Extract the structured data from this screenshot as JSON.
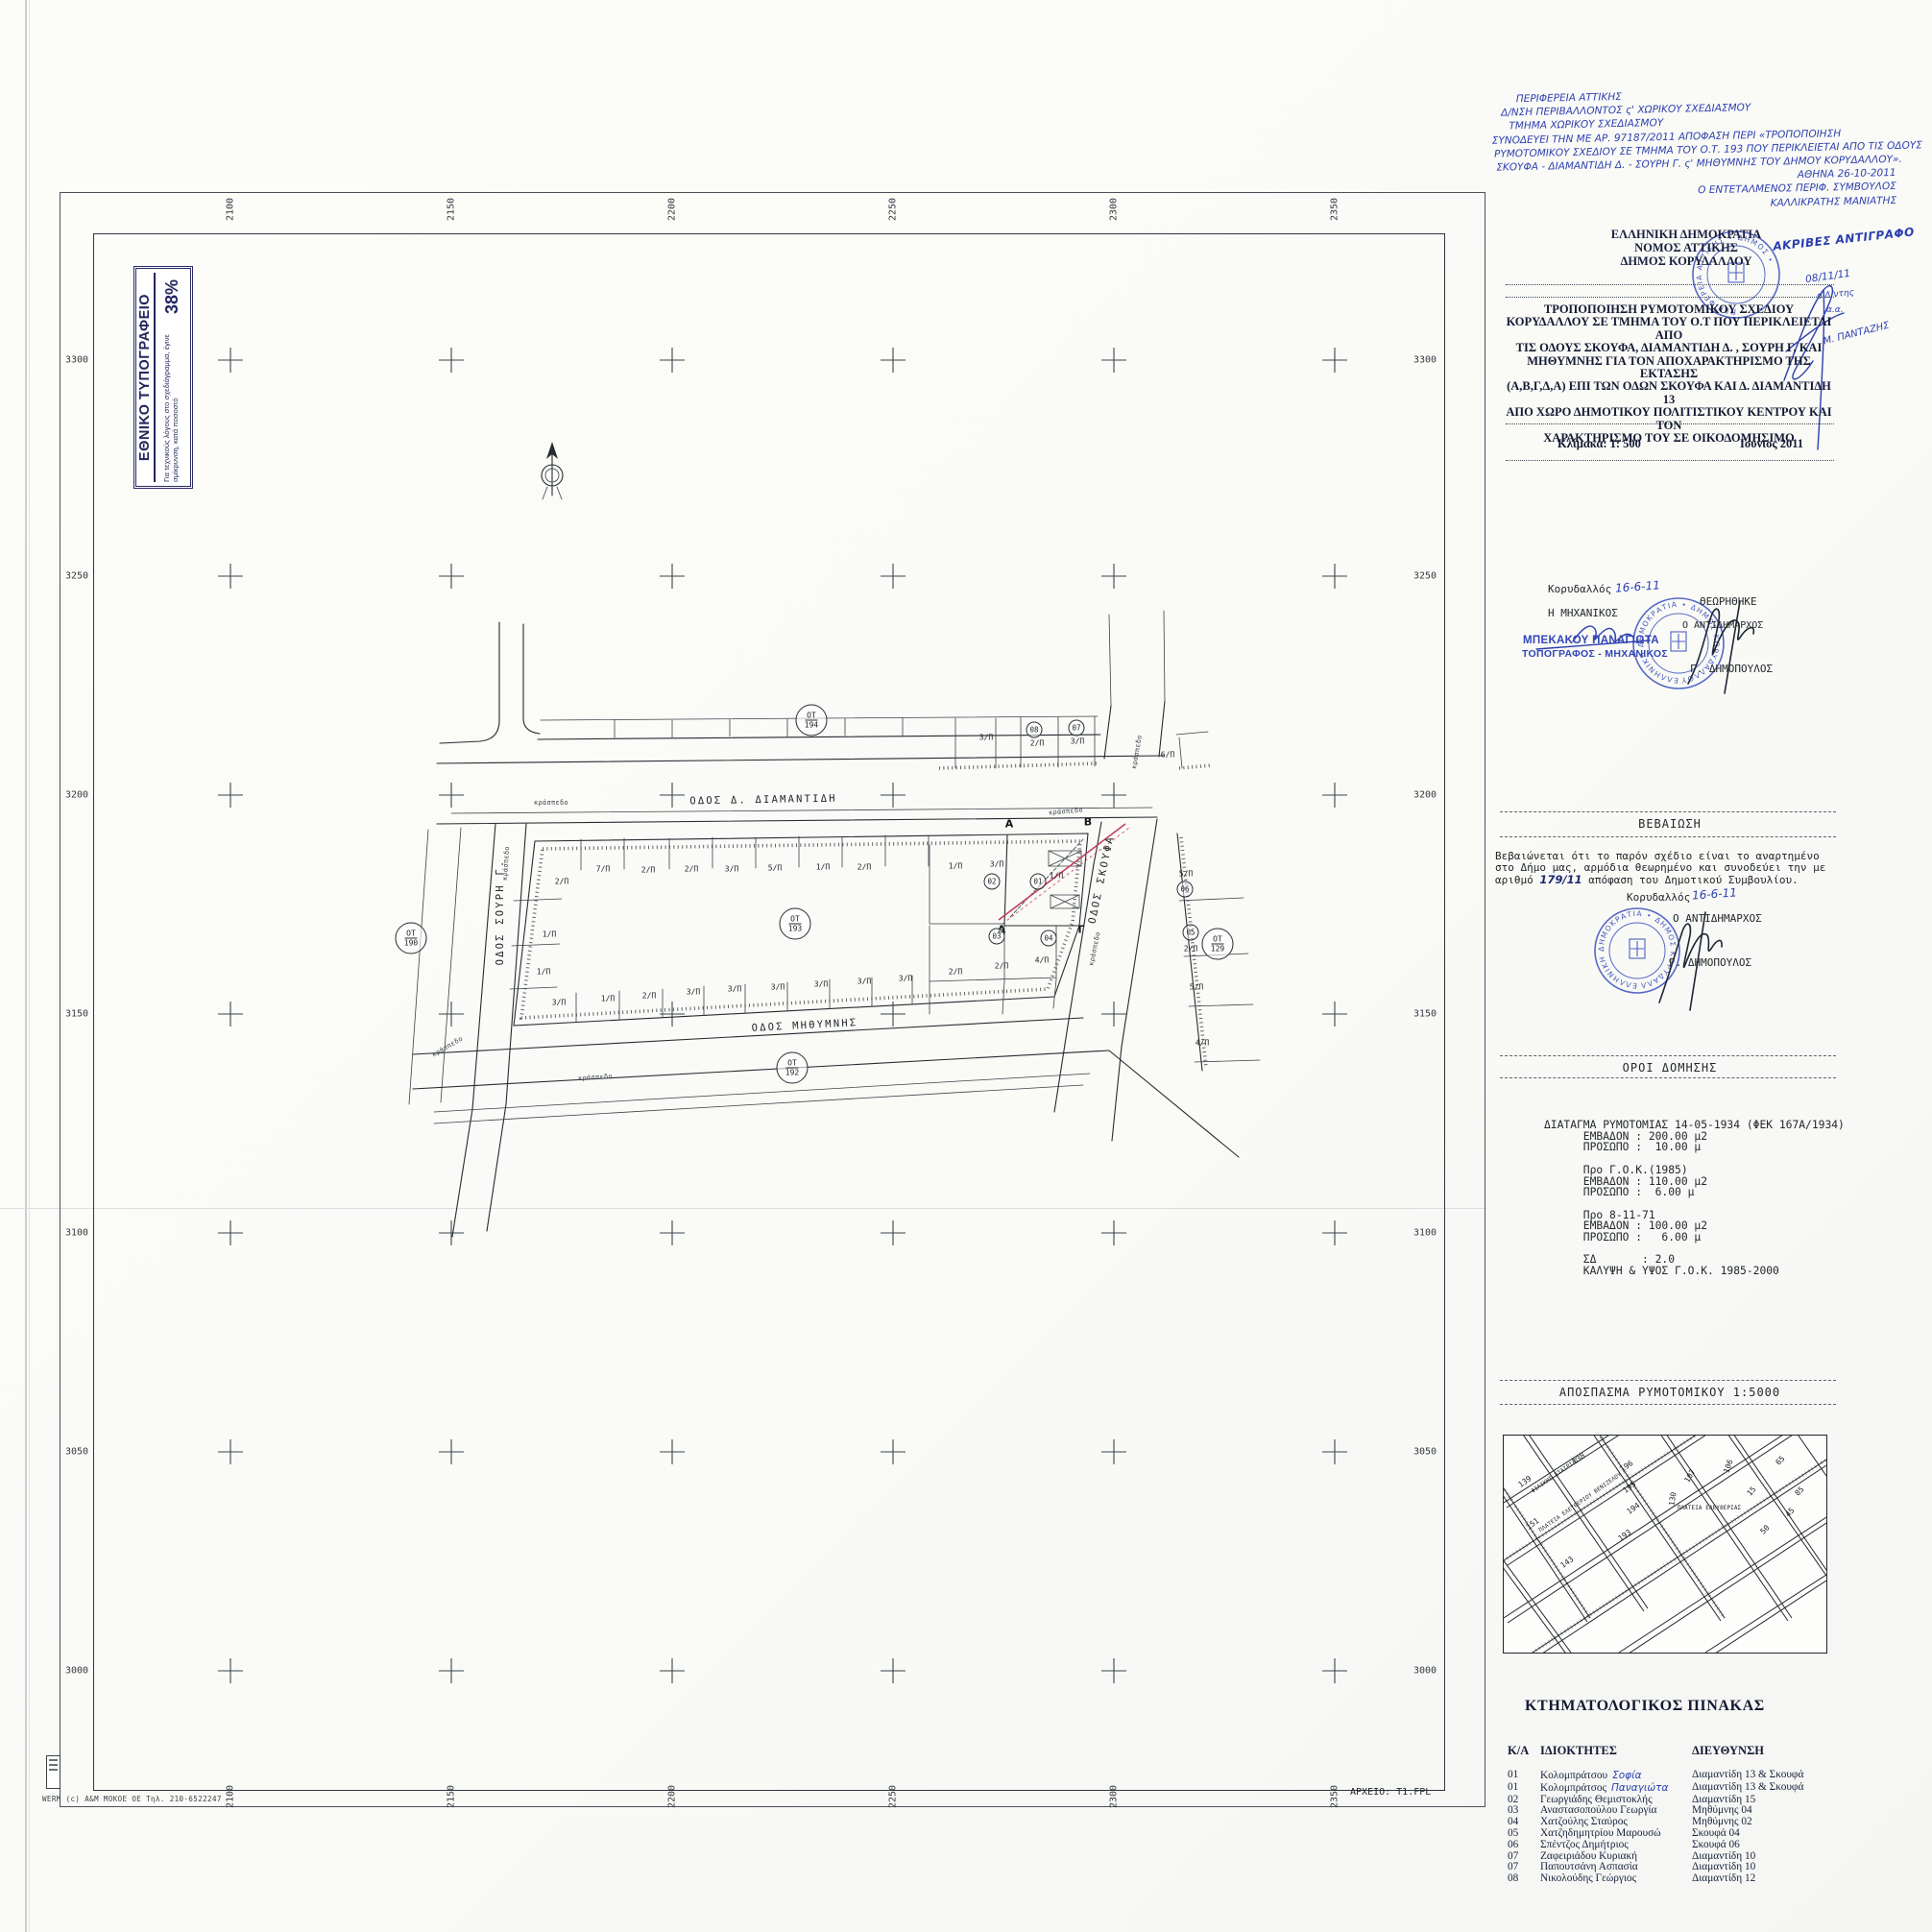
{
  "printing_stamp": {
    "title": "ΕΘΝΙΚΟ ΤΥΠΟΓΡΑΦΕΙΟ",
    "note": "Για τεχνικούς λόγους στο σχεδιάγραμμα, έγινε σμίκρυνση, κατά ποσοστό",
    "percent": "38%"
  },
  "scan_note": {
    "lines": [
      {
        "t": "ΠΕΡΙΦΕΡΕΙΑ ΑΤΤΙΚΗΣ",
        "indent": 26
      },
      {
        "t": "Δ/ΝΣΗ ΠΕΡΙΒΑΛΛΟΝΤΟΣ ς' ΧΩΡΙΚΟΥ ΣΧΕΔΙΑΣΜΟΥ",
        "indent": 10
      },
      {
        "t": "ΤΜΗΜΑ ΧΩΡΙΚΟΥ ΣΧΕΔΙΑΣΜΟΥ",
        "indent": 18
      },
      {
        "t": "ΣΥΝΟΔΕΥΕΙ ΤΗΝ ΜΕ ΑΡ. 97187/2011 ΑΠΟΦΑΣΗ ΠΕΡΙ «ΤΡΟΠΟΠΟΙΗΣΗ",
        "indent": 0
      },
      {
        "t": "ΡΥΜΟΤΟΜΙΚΟΥ ΣΧΕΔΙΟΥ ΣΕ ΤΜΗΜΑ ΤΟΥ Ο.Τ. 193 ΠΟΥ ΠΕΡΙΚΛΕΙΕΤΑΙ ΑΠΟ ΤΙΣ ΟΔΟΥΣ",
        "indent": 2
      },
      {
        "t": "ΣΚΟΥΦΑ - ΔΙΑΜΑΝΤΙΔΗ Δ. - ΣΟΥΡΗ Γ. ς' ΜΗΘΥΜΝΗΣ ΤΟΥ ΔΗΜΟΥ ΚΟΡΥΔΑΛΛΟΥ».",
        "indent": 4
      },
      {
        "t": "ΑΘΗΝΑ 26-10-2011",
        "align": "r"
      },
      {
        "t": "Ο ΕΝΤΕΤΑΛΜΕΝΟΣ ΠΕΡΙΦ. ΣΥΜΒΟΥΛΟΣ",
        "align": "r"
      },
      {
        "t": "ΚΑΛΛΙΚΡΑΤΗΣ ΜΑΝΙΑΤΗΣ",
        "align": "r"
      }
    ]
  },
  "gov_header": {
    "lines": [
      "ΕΛΛΗΝΙΚΗ ΔΗΜΟΚΡΑΤΙΑ",
      "ΝΟΜΟΣ ΑΤΤΙΚΗΣ",
      "ΔΗΜΟΣ ΚΟΡΥΔΑΛΛΟΥ"
    ],
    "copy_note": "ΑΚΡΙΒΕΣ ΑΝΤΙΓΡΑΦΟ",
    "date_hw": "08/11/11",
    "role_hw": "ο Δ/ντης",
    "aa_hw": "α.α.",
    "sign_name_hw": "Μ. ΠΑΝΤΑΖΗΣ"
  },
  "doc_title": {
    "lines": [
      "ΤΡΟΠΟΠΟΙΗΣΗ ΡΥΜΟΤΟΜΙΚΟΥ ΣΧΕΔΙΟΥ",
      "ΚΟΡΥΔΑΛΛΟΥ ΣΕ ΤΜΗΜΑ ΤΟΥ Ο.Τ ΠΟΥ ΠΕΡΙΚΛΕΙΕΤΑΙ ΑΠΟ",
      "ΤΙΣ ΟΔΟΥΣ ΣΚΟΥΦΑ, ΔΙΑΜΑΝΤΙΔΗ Δ. , ΣΟΥΡΗ Γ, ΚΑΙ",
      "ΜΗΘΥΜΝΗΣ ΓΙΑ ΤΟΝ ΑΠΟΧΑΡΑΚΤΗΡΙΣΜΟ ΤΗΣ ΕΚΤΑΣΗΣ",
      "(Α,Β,Γ,Δ,Α) ΕΠΙ ΤΩΝ ΟΔΩΝ ΣΚΟΥΦΑ ΚΑΙ Δ. ΔΙΑΜΑΝΤΙΔΗ 13",
      "ΑΠΟ ΧΩΡΟ ΔΗΜΟΤΙΚΟΥ ΠΟΛΙΤΙΣΤΙΚΟΥ ΚΕΝΤΡΟΥ ΚΑΙ ΤΟΝ",
      "ΧΑΡΑΚΤΗΡΙΣΜΟ ΤΟΥ ΣΕ ΟΙΚΟΔΟΜΗΣΙΜΟ"
    ],
    "scale": "Κλίμακα: 1: 500",
    "date": "Ιούνιος 2011"
  },
  "stamps": {
    "regional_ring": "ΠΕΡΙΦΕΡΕΙΑ ΑΤΤΙΚΗΣ • ΔΗΜΟΣ •",
    "municipal_ring": "ΕΛΛΗΝΙΚΗ ΔΗΜΟΚΡΑΤΙΑ • ΔΗΜΟΣ ΚΟΡΥΔΑΛΛΟΥ"
  },
  "engineer_block": {
    "place": "Κορυδαλλός",
    "date_hw": "16-6-11",
    "role": "Η ΜΗΧΑΝΙΚΟΣ",
    "stamp_name": "ΜΠΕΚΑΚΟΥ ΠΑΝΑΓΙΩΤΑ",
    "stamp_title": "ΤΟΠΟΓΡΑΦΟΣ - ΜΗΧΑΝΙΚΟΣ",
    "reviewed": "ΘΕΩΡΗΘΗΚΕ",
    "deputy_role": "Ο ΑΝΤΙΔΗΜΑΡΧΟΣ",
    "deputy_name": "Γ. ΔΗΜΟΠΟΥΛΟΣ"
  },
  "certification": {
    "title": "ΒΕΒΑΙΩΣΗ",
    "line1": "Βεβαιώνεται ότι το παρόν σχέδιο  είναι το αναρτημένο",
    "line2": "στο Δήμο μας, αρμόδια θεωρημένο και συνοδεύει την με",
    "line3_pre": "αριθμό ",
    "line3_hw": "179/11",
    "line3_post": "  απόφαση του Δημοτικού Συμβουλίου.",
    "place": "Κορυδαλλός",
    "date_hw": "16-6-11",
    "role": "Ο ΑΝΤΙΔΗΜΑΡΧΟΣ",
    "name": "Γ. ΔΗΜΟΠΟΥΛΟΣ"
  },
  "terms": {
    "title": "ΟΡΟΙ ΔΟΜΗΣΗΣ",
    "lines": [
      "ΔΙΑΤΑΓΜΑ ΡΥΜΟΤΟΜΙΑΣ 14-05-1934 (ΦΕΚ 167Α/1934)",
      "      ΕΜΒΑΔΟΝ : 200.00 μ2",
      "      ΠΡΟΣΩΠΟ :  10.00 μ",
      "",
      "      Προ Γ.Ο.Κ.(1985)",
      "      ΕΜΒΑΔΟΝ : 110.00 μ2",
      "      ΠΡΟΣΩΠΟ :  6.00 μ",
      "",
      "      Προ 8-11-71",
      "      ΕΜΒΑΔΟΝ : 100.00 μ2",
      "      ΠΡΟΣΩΠΟ :   6.00 μ",
      "",
      "      ΣΔ       : 2.0",
      "      ΚΑΛΥΨΗ & ΥΨΟΣ Γ.Ο.Κ. 1985-2000"
    ]
  },
  "excerpt": {
    "title": "ΑΠΟΣΠΑΣΜΑ ΡΥΜΟΤΟΜΙΚΟΥ 1:5000",
    "labels": [
      [
        "139",
        22,
        48,
        -35
      ],
      [
        "151",
        30,
        92,
        -35
      ],
      [
        "ΦΙΛΙΚΗΣ ΕΤΑΙΡΙΑΣ",
        54,
        42,
        -35,
        "xs"
      ],
      [
        "138",
        78,
        24,
        -35
      ],
      [
        "ΠΛΑΤΕΙΑ ΕΛΕΥΘΕΡΙΟΥ ΒΕΝΙΖΕΛΟΥ",
        80,
        70,
        -35,
        "xs"
      ],
      [
        "196",
        128,
        32,
        -35
      ],
      [
        "195",
        131,
        54,
        -35
      ],
      [
        "194",
        135,
        76,
        -35
      ],
      [
        "193",
        126,
        104,
        -35
      ],
      [
        "143",
        66,
        132,
        -35
      ],
      [
        "130",
        176,
        66,
        -80
      ],
      [
        "107",
        194,
        42,
        -60
      ],
      [
        "106",
        234,
        32,
        -70
      ],
      [
        "ΠΛΑΤΕΙΑ ΕΛΕΥΘΕΡΙΑΣ",
        214,
        76,
        0,
        "xs"
      ],
      [
        "15",
        258,
        58,
        -50
      ],
      [
        "65",
        288,
        26,
        -45
      ],
      [
        "85",
        308,
        58,
        -45
      ],
      [
        "50",
        272,
        98,
        -45
      ],
      [
        "45",
        298,
        80,
        -45
      ]
    ]
  },
  "cadastral": {
    "title": "ΚΤΗΜΑΤΟΛΟΓΙΚΟΣ ΠΙΝΑΚΑΣ",
    "headers": [
      "Κ/Α",
      "ΙΔΙΟΚΤΗΤΕΣ",
      "ΔΙΕΥΘΥΝΣΗ"
    ],
    "rows": [
      {
        "ka": "01",
        "owner": "Κολομπράτσου",
        "hw": "Σοφία",
        "addr": "Διαμαντίδη 13 & Σκουφά"
      },
      {
        "ka": "01",
        "owner": "Κολομπράτσος",
        "hw": "Παναγιώτα",
        "addr": "Διαμαντίδη 13 & Σκουφά"
      },
      {
        "ka": "02",
        "owner": "Γεωργιάδης Θεμιστοκλής",
        "hw": "",
        "addr": "Διαμαντίδη 15"
      },
      {
        "ka": "03",
        "owner": "Αναστασοπούλου Γεωργία",
        "hw": "",
        "addr": "Μηθύμνης  04"
      },
      {
        "ka": "04",
        "owner": "Χατζούλης Σταύρος",
        "hw": "",
        "addr": "Μηθύμνης  02"
      },
      {
        "ka": "05",
        "owner": "Χατζηδημητρίου Μαρουσώ",
        "hw": "",
        "addr": "Σκουφά    04"
      },
      {
        "ka": "06",
        "owner": "Σπέντζος Δημήτριος",
        "hw": "",
        "addr": "Σκουφά    06"
      },
      {
        "ka": "07",
        "owner": "Ζαφειριάδου Κυριακή",
        "hw": "",
        "addr": "Διαμαντίδη 10"
      },
      {
        "ka": "07",
        "owner": "Παπουτσάνη Ασπασία",
        "hw": "",
        "addr": "Διαμαντίδη 10"
      },
      {
        "ka": "08",
        "owner": "Νικολούδης Γεώργιος",
        "hw": "",
        "addr": "Διαμαντίδη 12"
      }
    ]
  },
  "map": {
    "grid": {
      "cols": [
        "2100",
        "2150",
        "2200",
        "2250",
        "2300",
        "2350"
      ],
      "rows": [
        "3300",
        "3250",
        "3200",
        "3150",
        "3100",
        "3050",
        "3000"
      ]
    },
    "ot_prefix": "ΟΤ",
    "ot_badges": [
      [
        "194",
        845,
        750
      ],
      [
        "190",
        428,
        977
      ],
      [
        "193",
        828,
        962
      ],
      [
        "192",
        825,
        1112
      ],
      [
        "129",
        1268,
        983
      ]
    ],
    "circled": [
      [
        "01",
        1081,
        918
      ],
      [
        "02",
        1033,
        918
      ],
      [
        "03",
        1038,
        975
      ],
      [
        "04",
        1092,
        977
      ],
      [
        "05",
        1240,
        971
      ],
      [
        "06",
        1234,
        926
      ],
      [
        "07",
        1121,
        758
      ],
      [
        "08",
        1077,
        760
      ]
    ],
    "points": [
      [
        "Α",
        1051,
        858
      ],
      [
        "Β",
        1133,
        856
      ],
      [
        "Γ",
        1126,
        968
      ],
      [
        "Δ",
        1043,
        968
      ]
    ],
    "streets": [
      [
        "ΟΔΟΣ Δ. ΔΙΑΜΑΝΤΙΔΗ",
        795,
        833,
        -1
      ],
      [
        "ΟΔΟΣ ΣΟΥΡΗ Γ.",
        521,
        950,
        -90
      ],
      [
        "ΟΔΟΣ ΜΗΘΥΜΝΗΣ",
        838,
        1068,
        -3
      ],
      [
        "ΟΔΟΣ ΣΚΟΥΦΑ",
        1147,
        916,
        -78
      ]
    ],
    "curbs": [
      [
        "κράσπεδο",
        574,
        836,
        0
      ],
      [
        "κράσπεδο",
        527,
        899,
        -86
      ],
      [
        "κράσπεδο",
        466,
        1090,
        -30
      ],
      [
        "κράσπεδο",
        620,
        1122,
        -3
      ],
      [
        "κράσπεδο",
        1110,
        845,
        -5
      ],
      [
        "κράσπεδο",
        1184,
        783,
        -80
      ],
      [
        "κράσπεδο",
        1140,
        988,
        -78
      ]
    ],
    "lots": [
      [
        "2/Π",
        585,
        918
      ],
      [
        "7/Π",
        628,
        905
      ],
      [
        "2/Π",
        675,
        906
      ],
      [
        "2/Π",
        720,
        905
      ],
      [
        "3/Π",
        762,
        905
      ],
      [
        "5/Π",
        807,
        904
      ],
      [
        "1/Π",
        857,
        903
      ],
      [
        "2/Π",
        900,
        903
      ],
      [
        "1/Π",
        995,
        902
      ],
      [
        "3/Π",
        1038,
        900
      ],
      [
        "1/Π",
        1100,
        912
      ],
      [
        "1/Π",
        572,
        973
      ],
      [
        "1/Π",
        566,
        1012
      ],
      [
        "3/Π",
        582,
        1044
      ],
      [
        "1/Π",
        633,
        1040
      ],
      [
        "2/Π",
        676,
        1037
      ],
      [
        "3/Π",
        722,
        1033
      ],
      [
        "3/Π",
        765,
        1030
      ],
      [
        "3/Π",
        810,
        1028
      ],
      [
        "3/Π",
        855,
        1025
      ],
      [
        "3/Π",
        900,
        1022
      ],
      [
        "3/Π",
        943,
        1019
      ],
      [
        "2/Π",
        995,
        1012
      ],
      [
        "2/Π",
        1043,
        1006
      ],
      [
        "4/Π",
        1085,
        1000
      ],
      [
        "3/Π",
        1027,
        768
      ],
      [
        "2/Π",
        1080,
        774
      ],
      [
        "3/Π",
        1122,
        772
      ],
      [
        "6/Π",
        1216,
        786
      ],
      [
        "5/Π",
        1235,
        910
      ],
      [
        "2/Π",
        1240,
        988
      ],
      [
        "5/Π",
        1246,
        1028
      ],
      [
        "4/Π",
        1252,
        1086
      ]
    ],
    "archive_note": "ΑΡΧΕΙΟ: Τ1.FPL",
    "printer_note": "WERM (c) A&M MOKOE OE   Τηλ. 210-6522247"
  }
}
